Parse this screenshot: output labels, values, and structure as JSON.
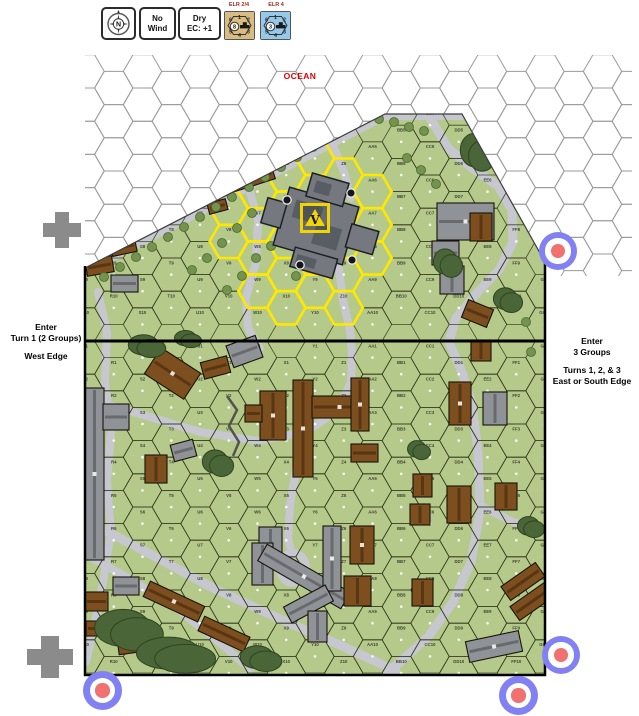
{
  "top_bar": {
    "compass": {
      "label": "N"
    },
    "chits": [
      {
        "top": "No",
        "bottom": "Wind"
      },
      {
        "top": "Dry",
        "bottom": "EC: +1"
      }
    ],
    "counters": [
      {
        "label": "ELR 2/4",
        "bg": "#d8bc82",
        "center_value": "8",
        "numbers_top": [
          "6",
          "1",
          "2"
        ],
        "numbers_bottom": [
          "5",
          "4",
          "3"
        ]
      },
      {
        "label": "ELR 4",
        "bg": "#96c8ea",
        "center_value": "3",
        "numbers_top": [
          "6",
          "1",
          "2"
        ],
        "numbers_bottom": [
          "5",
          "4",
          "3"
        ]
      }
    ]
  },
  "labels": {
    "ocean": "OCEAN",
    "fortress": "V",
    "west_entry": [
      "Enter",
      "Turn 1 (2 Groups)",
      "West Edge"
    ],
    "east_entry": [
      "Enter",
      "3 Groups",
      "Turns 1, 2, & 3",
      "East or South Edge"
    ]
  },
  "map": {
    "columns": [
      "Q",
      "R",
      "S",
      "T",
      "U",
      "V",
      "W",
      "X",
      "Y",
      "Z",
      "AA",
      "BB",
      "CC",
      "DD",
      "EE",
      "FF",
      "GG"
    ],
    "colors": {
      "land": "#b4c98a",
      "road": "#c7c7d0",
      "ocean_line": "#9a9a9a",
      "grid_line": "#2c3416",
      "highlight": "#ffe800",
      "tree": "#4a6537",
      "tree_edge": "#2e441f",
      "shrub": "#74934f",
      "shrub_edge": "#49692e",
      "brown_building": "#7d4f1f",
      "brown_dark": "#3f260c",
      "gray_building": "#8f9296",
      "gray_dark": "#4e5054",
      "fortress": "#75797f",
      "fortress_dark": "#54585e"
    },
    "roads": [
      {
        "w": 8,
        "p": [
          [
            80,
            274
          ],
          [
            385,
            116
          ],
          [
            462,
            116
          ]
        ]
      },
      {
        "w": 9,
        "p": [
          [
            430,
            118
          ],
          [
            448,
            148
          ],
          [
            472,
            168
          ],
          [
            498,
            186
          ],
          [
            512,
            210
          ],
          [
            513,
            242
          ],
          [
            499,
            270
          ],
          [
            476,
            294
          ],
          [
            456,
            318
          ],
          [
            449,
            342
          ]
        ]
      },
      {
        "w": 9,
        "p": [
          [
            449,
            342
          ],
          [
            462,
            372
          ],
          [
            472,
            404
          ],
          [
            478,
            452
          ],
          [
            480,
            512
          ],
          [
            471,
            562
          ],
          [
            453,
            602
          ],
          [
            428,
            637
          ],
          [
            400,
            662
          ],
          [
            386,
            674
          ]
        ]
      },
      {
        "w": 8,
        "p": [
          [
            479,
            505
          ],
          [
            513,
            522
          ],
          [
            545,
            530
          ]
        ]
      },
      {
        "w": 8,
        "p": [
          [
            98,
            292
          ],
          [
            107,
            332
          ],
          [
            105,
            382
          ],
          [
            111,
            432
          ],
          [
            107,
            482
          ],
          [
            111,
            532
          ],
          [
            103,
            582
          ],
          [
            94,
            627
          ],
          [
            86,
            662
          ]
        ]
      },
      {
        "w": 8,
        "p": [
          [
            85,
            398
          ],
          [
            140,
            414
          ],
          [
            200,
            432
          ],
          [
            258,
            441
          ],
          [
            306,
            432
          ],
          [
            338,
            410
          ],
          [
            351,
            382
          ],
          [
            352,
            350
          ]
        ]
      },
      {
        "w": 8,
        "p": [
          [
            338,
            262
          ],
          [
            343,
            300
          ],
          [
            350,
            330
          ],
          [
            352,
            354
          ]
        ]
      },
      {
        "w": 8,
        "p": [
          [
            306,
            432
          ],
          [
            296,
            470
          ],
          [
            290,
            505
          ],
          [
            288,
            540
          ],
          [
            293,
            556
          ]
        ]
      },
      {
        "w": 8,
        "p": [
          [
            248,
            185
          ],
          [
            258,
            220
          ],
          [
            256,
            262
          ],
          [
            246,
            298
          ],
          [
            248,
            328
          ],
          [
            260,
            348
          ]
        ]
      },
      {
        "w": 8,
        "p": [
          [
            331,
            141
          ],
          [
            344,
            172
          ],
          [
            351,
            198
          ]
        ]
      },
      {
        "w": 9,
        "p": [
          [
            85,
            520
          ],
          [
            150,
            554
          ],
          [
            215,
            589
          ],
          [
            280,
            619
          ],
          [
            340,
            645
          ],
          [
            396,
            671
          ]
        ]
      },
      {
        "w": 8,
        "p": [
          [
            85,
            554
          ],
          [
            130,
            579
          ],
          [
            180,
            611
          ],
          [
            225,
            647
          ],
          [
            250,
            669
          ]
        ]
      }
    ],
    "buildings": [
      {
        "t": "b",
        "x": 229,
        "y": 177,
        "w": 26,
        "h": 12,
        "a": -18
      },
      {
        "t": "b",
        "x": 248,
        "y": 170,
        "w": 26,
        "h": 13,
        "a": -18
      },
      {
        "t": "b",
        "x": 203,
        "y": 188,
        "w": 17,
        "h": 11,
        "a": -15
      },
      {
        "t": "b",
        "x": 208,
        "y": 201,
        "w": 19,
        "h": 11,
        "a": -15
      },
      {
        "t": "b",
        "x": 111,
        "y": 240,
        "w": 25,
        "h": 14,
        "a": -12
      },
      {
        "t": "b",
        "x": 86,
        "y": 258,
        "w": 27,
        "h": 16,
        "a": -10
      },
      {
        "t": "g",
        "x": 111,
        "y": 275,
        "w": 27,
        "h": 17,
        "a": 0
      },
      {
        "t": "g",
        "x": 437,
        "y": 203,
        "w": 57,
        "h": 37,
        "a": 0
      },
      {
        "t": "g",
        "x": 432,
        "y": 241,
        "w": 27,
        "h": 24,
        "a": 0
      },
      {
        "t": "g",
        "x": 440,
        "y": 266,
        "w": 24,
        "h": 28,
        "a": 0
      },
      {
        "t": "b",
        "x": 470,
        "y": 213,
        "w": 22,
        "h": 28,
        "a": 0
      },
      {
        "t": "b",
        "x": 464,
        "y": 304,
        "w": 27,
        "h": 19,
        "a": 22
      },
      {
        "t": "g",
        "x": 85,
        "y": 388,
        "w": 19,
        "h": 172,
        "a": 0
      },
      {
        "t": "g",
        "x": 103,
        "y": 404,
        "w": 26,
        "h": 26,
        "a": 0
      },
      {
        "t": "b",
        "x": 149,
        "y": 358,
        "w": 47,
        "h": 31,
        "a": 33
      },
      {
        "t": "b",
        "x": 202,
        "y": 359,
        "w": 27,
        "h": 17,
        "a": -15
      },
      {
        "t": "g",
        "x": 229,
        "y": 340,
        "w": 31,
        "h": 23,
        "a": -20
      },
      {
        "t": "b",
        "x": 145,
        "y": 455,
        "w": 22,
        "h": 28,
        "a": 0
      },
      {
        "t": "g",
        "x": 172,
        "y": 442,
        "w": 23,
        "h": 17,
        "a": -15
      },
      {
        "t": "b",
        "x": 260,
        "y": 391,
        "w": 26,
        "h": 49,
        "a": 0
      },
      {
        "t": "b",
        "x": 245,
        "y": 405,
        "w": 17,
        "h": 17,
        "a": 0
      },
      {
        "t": "b",
        "x": 293,
        "y": 380,
        "w": 20,
        "h": 97,
        "a": 0
      },
      {
        "t": "b",
        "x": 312,
        "y": 396,
        "w": 55,
        "h": 22,
        "a": 0
      },
      {
        "t": "b",
        "x": 351,
        "y": 378,
        "w": 18,
        "h": 53,
        "a": 0
      },
      {
        "t": "b",
        "x": 351,
        "y": 444,
        "w": 27,
        "h": 18,
        "a": 0
      },
      {
        "t": "b",
        "x": 413,
        "y": 474,
        "w": 19,
        "h": 23,
        "a": 0
      },
      {
        "t": "b",
        "x": 410,
        "y": 504,
        "w": 20,
        "h": 21,
        "a": 0
      },
      {
        "t": "b",
        "x": 449,
        "y": 382,
        "w": 22,
        "h": 43,
        "a": 0
      },
      {
        "t": "g",
        "x": 483,
        "y": 392,
        "w": 24,
        "h": 33,
        "a": 0
      },
      {
        "t": "b",
        "x": 471,
        "y": 340,
        "w": 20,
        "h": 21,
        "a": 0
      },
      {
        "t": "b",
        "x": 447,
        "y": 486,
        "w": 24,
        "h": 37,
        "a": 0
      },
      {
        "t": "b",
        "x": 495,
        "y": 483,
        "w": 22,
        "h": 27,
        "a": 0
      },
      {
        "t": "g",
        "x": 259,
        "y": 527,
        "w": 23,
        "h": 31,
        "a": 0
      },
      {
        "t": "g",
        "x": 252,
        "y": 543,
        "w": 21,
        "h": 42,
        "a": 0
      },
      {
        "t": "g",
        "x": 256,
        "y": 567,
        "w": 96,
        "h": 19,
        "a": 30
      },
      {
        "t": "g",
        "x": 323,
        "y": 526,
        "w": 18,
        "h": 65,
        "a": 0
      },
      {
        "t": "b",
        "x": 350,
        "y": 526,
        "w": 24,
        "h": 38,
        "a": 0
      },
      {
        "t": "b",
        "x": 344,
        "y": 576,
        "w": 27,
        "h": 30,
        "a": 0
      },
      {
        "t": "g",
        "x": 285,
        "y": 595,
        "w": 47,
        "h": 18,
        "a": -28
      },
      {
        "t": "g",
        "x": 308,
        "y": 611,
        "w": 19,
        "h": 31,
        "a": 0
      },
      {
        "t": "b",
        "x": 85,
        "y": 592,
        "w": 23,
        "h": 19,
        "a": 0
      },
      {
        "t": "b",
        "x": 86,
        "y": 621,
        "w": 25,
        "h": 15,
        "a": 0
      },
      {
        "t": "b",
        "x": 118,
        "y": 637,
        "w": 27,
        "h": 16,
        "a": -8
      },
      {
        "t": "g",
        "x": 113,
        "y": 577,
        "w": 26,
        "h": 18,
        "a": 0
      },
      {
        "t": "b",
        "x": 144,
        "y": 593,
        "w": 60,
        "h": 17,
        "a": 25
      },
      {
        "t": "b",
        "x": 199,
        "y": 626,
        "w": 50,
        "h": 16,
        "a": 25
      },
      {
        "t": "b",
        "x": 502,
        "y": 573,
        "w": 42,
        "h": 17,
        "a": -35
      },
      {
        "t": "b",
        "x": 511,
        "y": 593,
        "w": 42,
        "h": 17,
        "a": -35
      },
      {
        "t": "g",
        "x": 467,
        "y": 636,
        "w": 54,
        "h": 21,
        "a": -12
      },
      {
        "t": "b",
        "x": 412,
        "y": 579,
        "w": 21,
        "h": 27,
        "a": 0
      }
    ],
    "trees": [
      {
        "x": 461,
        "y": 132,
        "w": 34,
        "h": 40
      },
      {
        "x": 434,
        "y": 248,
        "w": 28,
        "h": 30
      },
      {
        "x": 494,
        "y": 287,
        "w": 28,
        "h": 26
      },
      {
        "x": 129,
        "y": 334,
        "w": 36,
        "h": 24
      },
      {
        "x": 175,
        "y": 330,
        "w": 26,
        "h": 18
      },
      {
        "x": 203,
        "y": 449,
        "w": 30,
        "h": 28
      },
      {
        "x": 96,
        "y": 608,
        "w": 66,
        "h": 44
      },
      {
        "x": 138,
        "y": 636,
        "w": 76,
        "h": 38
      },
      {
        "x": 241,
        "y": 645,
        "w": 40,
        "h": 27
      },
      {
        "x": 408,
        "y": 440,
        "w": 22,
        "h": 20
      },
      {
        "x": 518,
        "y": 516,
        "w": 26,
        "h": 22
      }
    ],
    "shrubs": [
      [
        152,
        247
      ],
      [
        168,
        237
      ],
      [
        184,
        227
      ],
      [
        200,
        217
      ],
      [
        216,
        207
      ],
      [
        232,
        197
      ],
      [
        249,
        187
      ],
      [
        265,
        177
      ],
      [
        281,
        167
      ],
      [
        297,
        157
      ],
      [
        313,
        147
      ],
      [
        329,
        137
      ],
      [
        345,
        127
      ],
      [
        362,
        121
      ],
      [
        136,
        257
      ],
      [
        120,
        267
      ],
      [
        104,
        277
      ],
      [
        379,
        119
      ],
      [
        394,
        122
      ],
      [
        409,
        127
      ],
      [
        424,
        131
      ],
      [
        300,
        126
      ],
      [
        284,
        138
      ],
      [
        268,
        148
      ],
      [
        252,
        158
      ],
      [
        407,
        158
      ],
      [
        421,
        170
      ],
      [
        436,
        184
      ],
      [
        252,
        213
      ],
      [
        237,
        228
      ],
      [
        222,
        243
      ],
      [
        207,
        258
      ],
      [
        192,
        270
      ],
      [
        256,
        258
      ],
      [
        271,
        246
      ],
      [
        242,
        276
      ],
      [
        227,
        290
      ],
      [
        296,
        276
      ],
      [
        311,
        262
      ],
      [
        526,
        322
      ],
      [
        531,
        352
      ]
    ],
    "walls": [
      [
        [
          227,
          396
        ],
        [
          237,
          410
        ],
        [
          229,
          426
        ],
        [
          239,
          442
        ],
        [
          233,
          456
        ]
      ]
    ],
    "fortress_parts": [
      [
        280,
        196,
        72,
        60
      ],
      [
        298,
        176,
        38,
        24
      ],
      [
        350,
        214,
        28,
        24
      ],
      [
        302,
        252,
        44,
        20
      ],
      [
        262,
        212,
        20,
        26
      ]
    ],
    "fortress_details": [
      [
        290,
        206,
        28,
        18
      ],
      [
        316,
        222,
        26,
        22
      ],
      [
        306,
        258,
        20,
        10
      ],
      [
        304,
        182,
        16,
        12
      ]
    ],
    "cupolas": [
      [
        287,
        200
      ],
      [
        351,
        193
      ],
      [
        300,
        265
      ],
      [
        352,
        260
      ]
    ],
    "highlight_center": [
      312,
      228
    ],
    "highlight_radius": 86
  },
  "markers": {
    "crosses": [
      {
        "x": 43,
        "y": 212,
        "w": 38,
        "h": 36
      },
      {
        "x": 27,
        "y": 636,
        "w": 46,
        "h": 42
      }
    ],
    "roundels": [
      {
        "x": 539,
        "y": 232,
        "d": 38
      },
      {
        "x": 83,
        "y": 671,
        "d": 39
      },
      {
        "x": 542,
        "y": 636,
        "d": 38
      },
      {
        "x": 499,
        "y": 676,
        "d": 39
      }
    ]
  }
}
